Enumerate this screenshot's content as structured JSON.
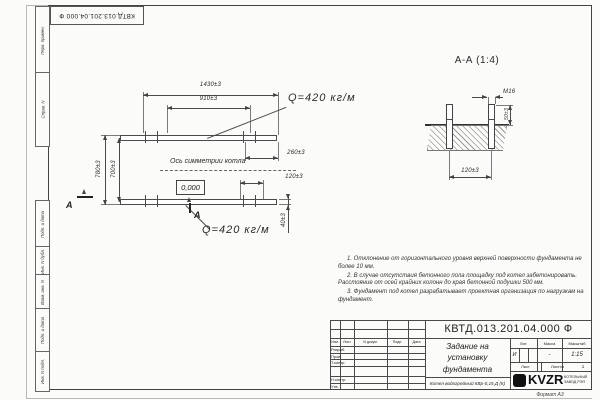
{
  "frame": {
    "stamp_top": "КВТД.013.201.04.000 Ф",
    "strip_labels": [
      "Перв. примен.",
      "Справ. N",
      "Подп. и дата",
      "Инв. N дубл.",
      "Взам. инв. N",
      "Подп. и дата",
      "Инв. N подл."
    ],
    "format_note": "Формат А3"
  },
  "plan": {
    "dims": {
      "d1430": "1430±3",
      "d910": "910±3",
      "d780": "780±3",
      "d700": "700±3",
      "d260": "260±3",
      "d120": "120±3",
      "d40": "40±3"
    },
    "load_top": "Q=420 кг/м",
    "load_bottom": "Q=420 кг/м",
    "axis_label": "Ось симметрии котла",
    "elevation": "0,000",
    "section_letter": "А"
  },
  "section": {
    "title": "А-А (1:4)",
    "bolt": "М16",
    "d50": "50±3",
    "d120": "120±3"
  },
  "notes": [
    "1. Отклонение от горизонтального уровня верхней поверхности фундамента не более 10 мм.",
    "2. В случае отсутствия бетонного пола площадку под котел забетонировать. Расстояние от осей крайних колонн до края бетонной подушки 500 мм.",
    "3. Фундамент под котел разрабатывает проектная организация по нагрузкам на фундамент."
  ],
  "title_block": {
    "designation": "КВТД.013.201.04.000 Ф",
    "header_cols": [
      "Изм.",
      "Лист",
      "N докум.",
      "Подп.",
      "Дата"
    ],
    "sig_rows": [
      "Разраб.",
      "Пров.",
      "Т.контр.",
      "Н.контр.",
      "Утв."
    ],
    "title_lines": [
      "Задание на",
      "установку",
      "фундамента"
    ],
    "lit_label": "Лит.",
    "lit_value": "И",
    "mass_label": "Масса",
    "mass_value": "-",
    "scale_label": "Масштаб",
    "scale_value": "1:15",
    "sheet_label": "Лист",
    "sheets_label": "Листов",
    "sheets_value": "1",
    "product": "Котел водогрейный КВр-0,15 Д (К)",
    "logo_text": "KVZR",
    "logo_sub1": "КОТЕЛЬНЫЙ",
    "logo_sub2": "ЗАВОД РЭП"
  },
  "colors": {
    "line": "#4a4a4a",
    "sheet": "#fbfbfa",
    "background": "#e9e9e7"
  }
}
